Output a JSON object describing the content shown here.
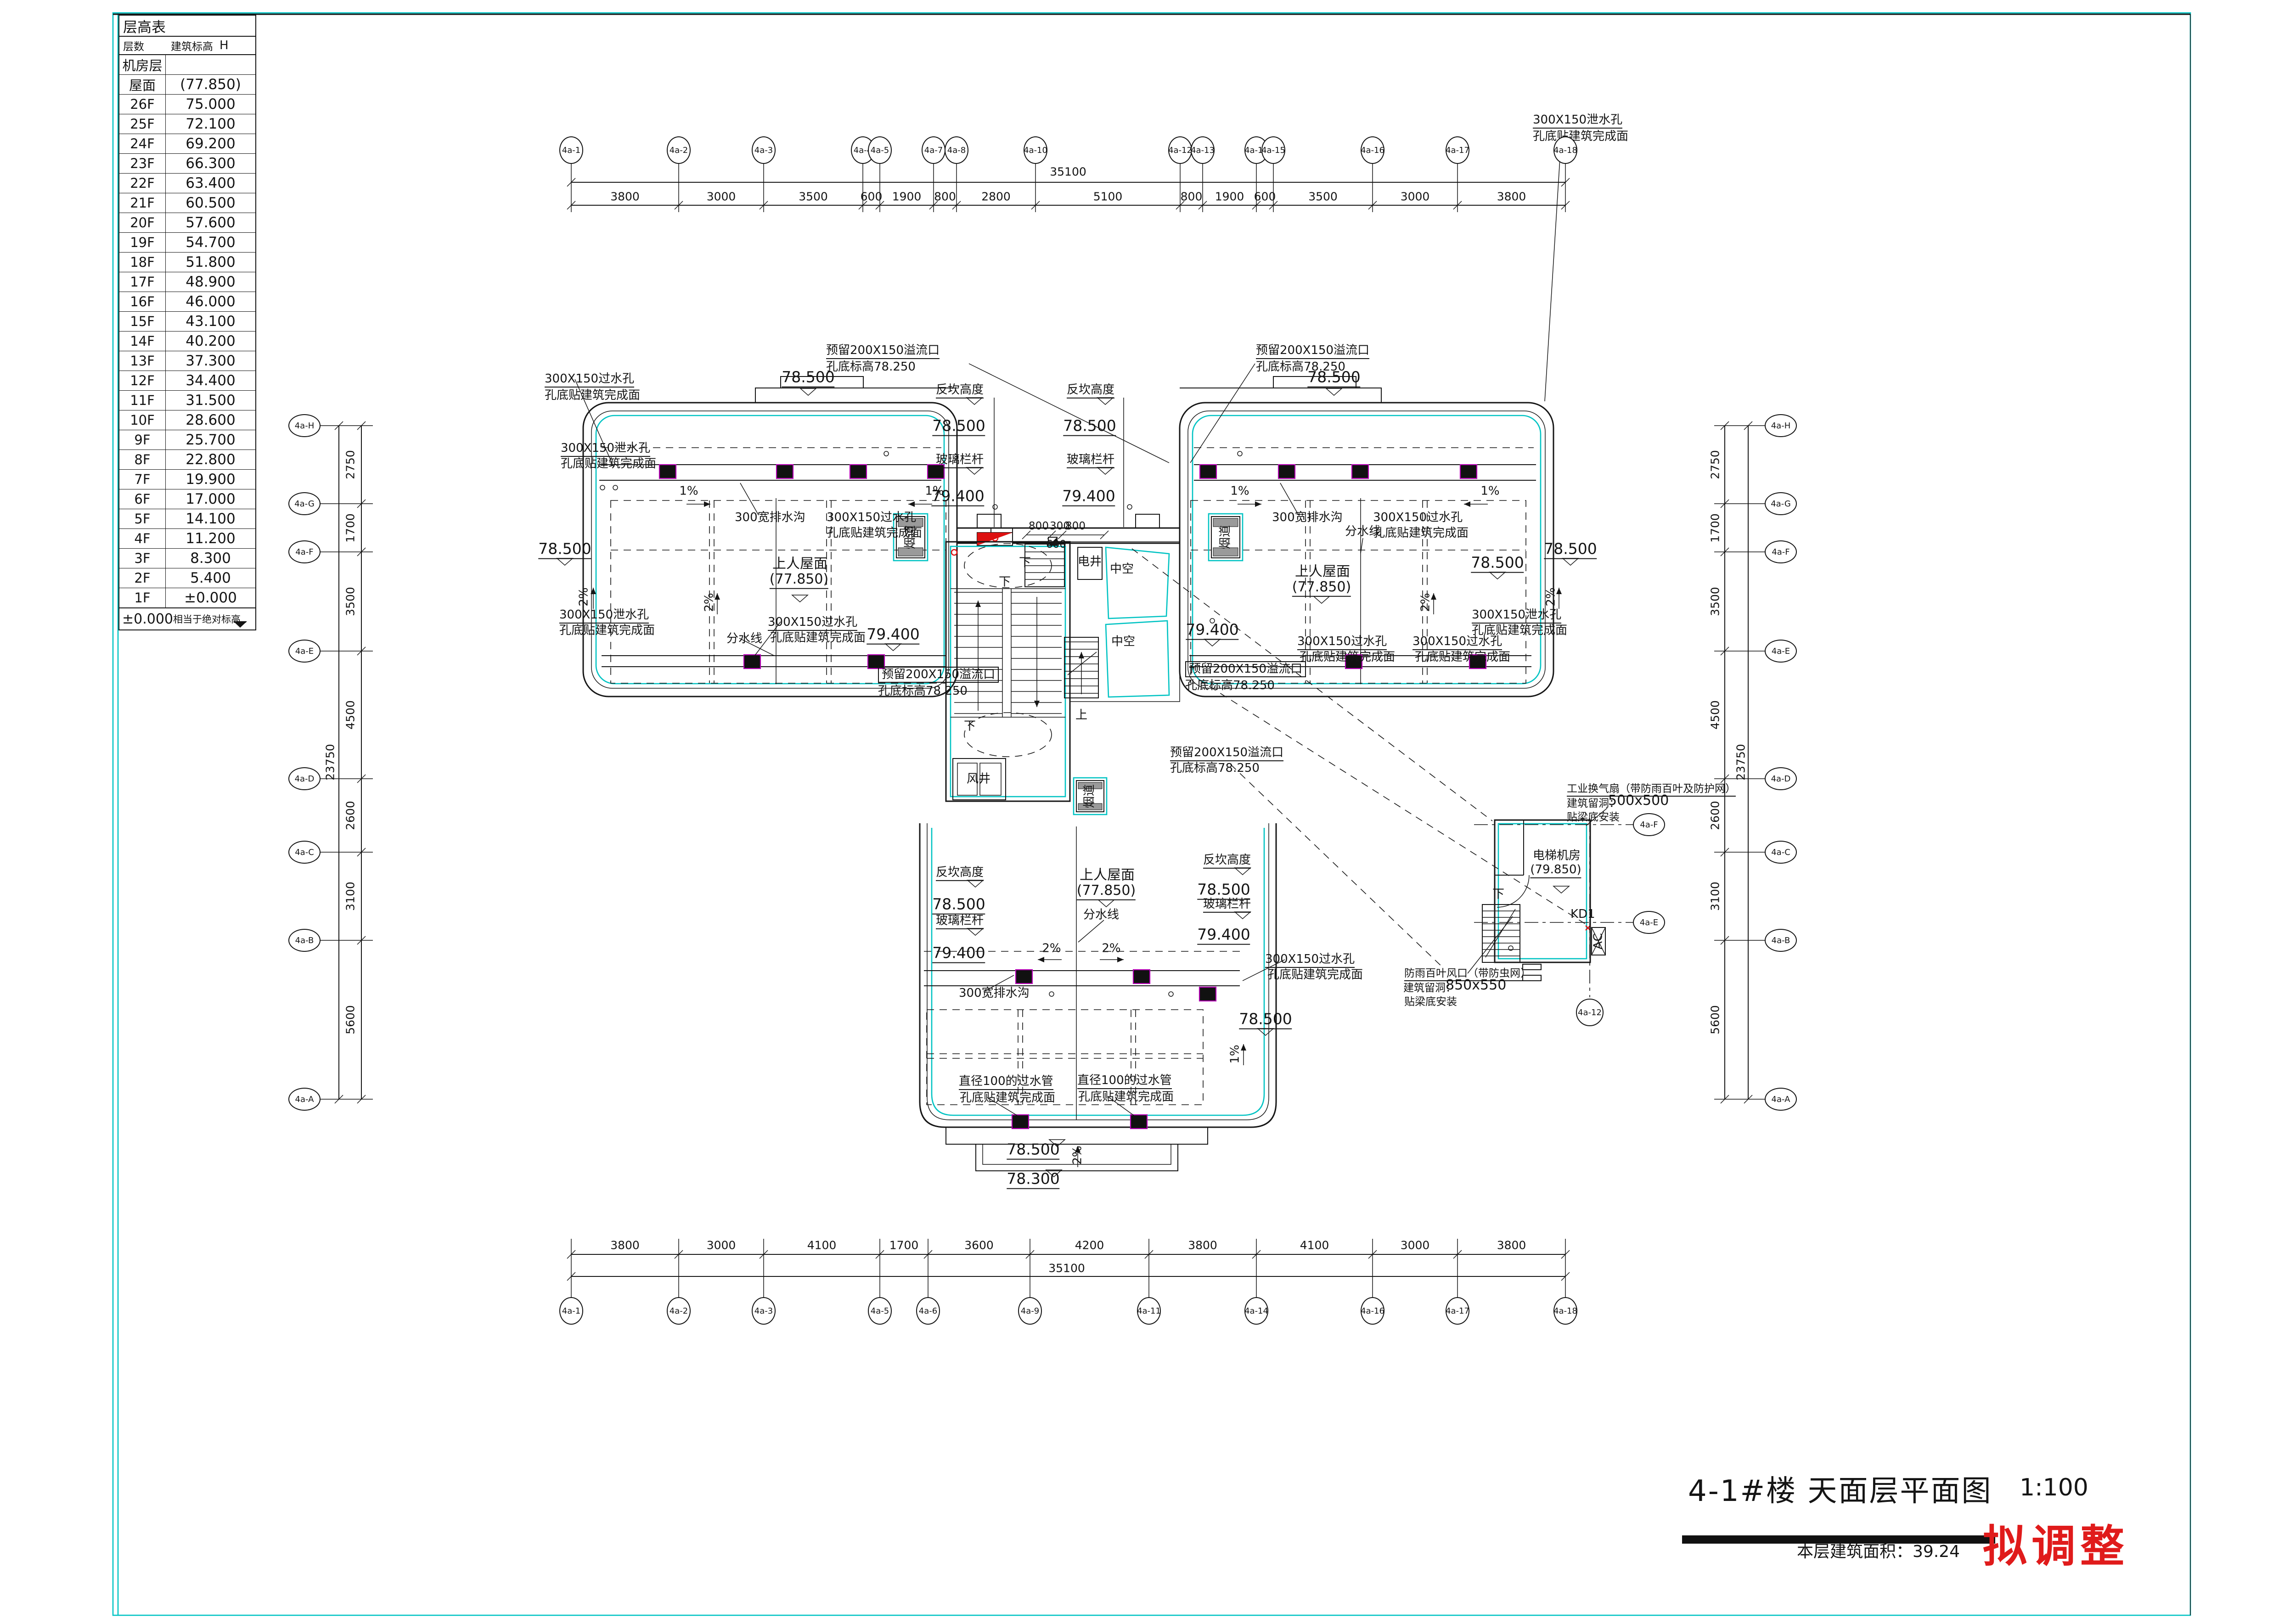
{
  "sheet": {
    "title": "4-1#楼  天面层平面图",
    "scale": "1:100",
    "area_label": "本层建筑面积：39.24",
    "stamp": "拟调整"
  },
  "floor_table": {
    "title": "层高表",
    "col_floor": "层数",
    "col_elev": "建筑标高",
    "col_h": "H",
    "rows": [
      {
        "floor": "机房层",
        "elev": ""
      },
      {
        "floor": "屋面",
        "elev": "(77.850)"
      },
      {
        "floor": "26F",
        "elev": "75.000"
      },
      {
        "floor": "25F",
        "elev": "72.100"
      },
      {
        "floor": "24F",
        "elev": "69.200"
      },
      {
        "floor": "23F",
        "elev": "66.300"
      },
      {
        "floor": "22F",
        "elev": "63.400"
      },
      {
        "floor": "21F",
        "elev": "60.500"
      },
      {
        "floor": "20F",
        "elev": "57.600"
      },
      {
        "floor": "19F",
        "elev": "54.700"
      },
      {
        "floor": "18F",
        "elev": "51.800"
      },
      {
        "floor": "17F",
        "elev": "48.900"
      },
      {
        "floor": "16F",
        "elev": "46.000"
      },
      {
        "floor": "15F",
        "elev": "43.100"
      },
      {
        "floor": "14F",
        "elev": "40.200"
      },
      {
        "floor": "13F",
        "elev": "37.300"
      },
      {
        "floor": "12F",
        "elev": "34.400"
      },
      {
        "floor": "11F",
        "elev": "31.500"
      },
      {
        "floor": "10F",
        "elev": "28.600"
      },
      {
        "floor": "9F",
        "elev": "25.700"
      },
      {
        "floor": "8F",
        "elev": "22.800"
      },
      {
        "floor": "7F",
        "elev": "19.900"
      },
      {
        "floor": "6F",
        "elev": "17.000"
      },
      {
        "floor": "5F",
        "elev": "14.100"
      },
      {
        "floor": "4F",
        "elev": "11.200"
      },
      {
        "floor": "3F",
        "elev": "8.300"
      },
      {
        "floor": "2F",
        "elev": "5.400"
      },
      {
        "floor": "1F",
        "elev": "±0.000"
      }
    ],
    "footnote_value": "±0.000",
    "footnote_text": "相当于绝对标高"
  },
  "axes": {
    "top": {
      "labels": [
        "4a-1",
        "4a-2",
        "4a-3",
        "4a-4",
        "4a-5",
        "4a-7",
        "4a-8",
        "4a-10",
        "4a-12",
        "4a-13",
        "4a-14",
        "4a-15",
        "4a-16",
        "4a-17",
        "4a-18"
      ],
      "dims": [
        "3800",
        "3000",
        "3500",
        "600",
        "1900",
        "800",
        "2800",
        "5100",
        "800",
        "1900",
        "600",
        "3500",
        "3000",
        "3800"
      ],
      "total": "35100"
    },
    "bottom": {
      "labels": [
        "4a-1",
        "4a-2",
        "4a-3",
        "4a-5",
        "4a-6",
        "4a-9",
        "4a-11",
        "4a-14",
        "4a-16",
        "4a-17",
        "4a-18"
      ],
      "dims": [
        "3800",
        "3000",
        "4100",
        "1700",
        "3600",
        "4200",
        "3800",
        "4100",
        "3000",
        "3800"
      ],
      "total": "35100"
    },
    "left": {
      "labels": [
        "4a-H",
        "4a-G",
        "4a-F",
        "4a-E",
        "4a-D",
        "4a-C",
        "4a-B",
        "4a-A"
      ],
      "dims": [
        "2750",
        "1700",
        "3500",
        "4500",
        "2600",
        "3100",
        "5600"
      ],
      "total": "23750"
    },
    "right": {
      "labels": [
        "4a-H",
        "4a-G",
        "4a-F",
        "4a-E",
        "4a-D",
        "4a-C",
        "4a-B",
        "4a-A"
      ],
      "dims": [
        "2750",
        "1700",
        "3500",
        "4500",
        "2600",
        "3100",
        "5600"
      ],
      "total": "23750"
    },
    "inner": [
      "4a-F",
      "4a-E",
      "4a-12"
    ]
  },
  "labels": {
    "fankan": "反坎高度",
    "glass_rail": "玻璃栏杆",
    "e78500": "78.500",
    "e79400": "79.400",
    "e78300": "78.300",
    "overflow": "预留200X150溢流口",
    "e78250_note": "孔底标高78.250",
    "pass_hole": "300X150过水孔",
    "drain_hole": "300X150泄水孔",
    "hole_note": "孔底贴建筑完成面",
    "drain300": "300宽排水沟",
    "pipe100": "直径100的过水管",
    "roof_access": "上人屋面",
    "roof_elev": "(77.850)",
    "divide": "分水线",
    "pct1": "1%",
    "pct2": "2%",
    "yandao": "烟道",
    "fengjing": "风井",
    "dianjing": "电井",
    "zhongkong": "中空",
    "shang": "上",
    "xia": "下",
    "elev_room": "电梯机房",
    "elev_room_lvl": "(79.850)",
    "kd1": "KD1",
    "ac": "AC",
    "fan_note1": "工业换气扇（带防雨百叶及防护网）",
    "fan_note2": "建筑留洞：",
    "size500": "500x500",
    "size850": "850x550",
    "fan_note3": "贴梁底安装",
    "louver1": "防雨百叶风口（带防虫网）",
    "d800": "800",
    "d300": "300",
    "d600": "600"
  }
}
